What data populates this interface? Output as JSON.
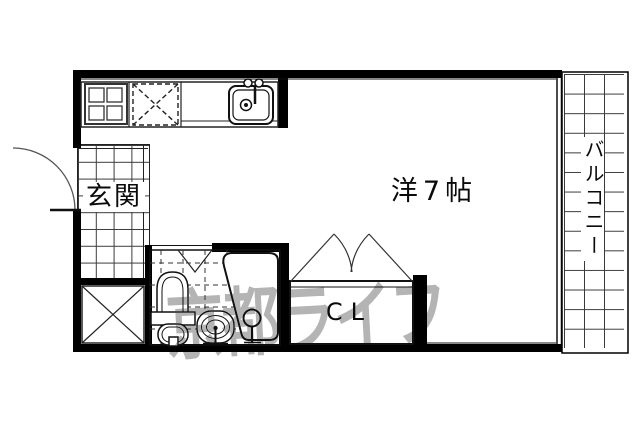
{
  "floor_plan": {
    "rooms": {
      "entrance": {
        "label": "玄関"
      },
      "main_room": {
        "label": "洋7帖"
      },
      "closet": {
        "label": "CL"
      },
      "balcony": {
        "label": "バルコニー"
      }
    },
    "watermark": {
      "text": "京都ライフ",
      "color": "#b4b4b4"
    },
    "fixture_names": [
      "stove-icon",
      "refrigerator-space-icon",
      "kitchen-sink-icon",
      "entry-door-arc-icon",
      "shoe-storage-x-icon",
      "bath-door-v-icon",
      "toilet-icon",
      "washbasin-icon",
      "bathtub-icon",
      "shower-tap-icon",
      "closet-double-door-icon",
      "window-sliding-icon"
    ],
    "colors": {
      "wall": "#000000",
      "line": "#111111",
      "grid_line": "#3a3a3a",
      "background": "#ffffff"
    }
  }
}
